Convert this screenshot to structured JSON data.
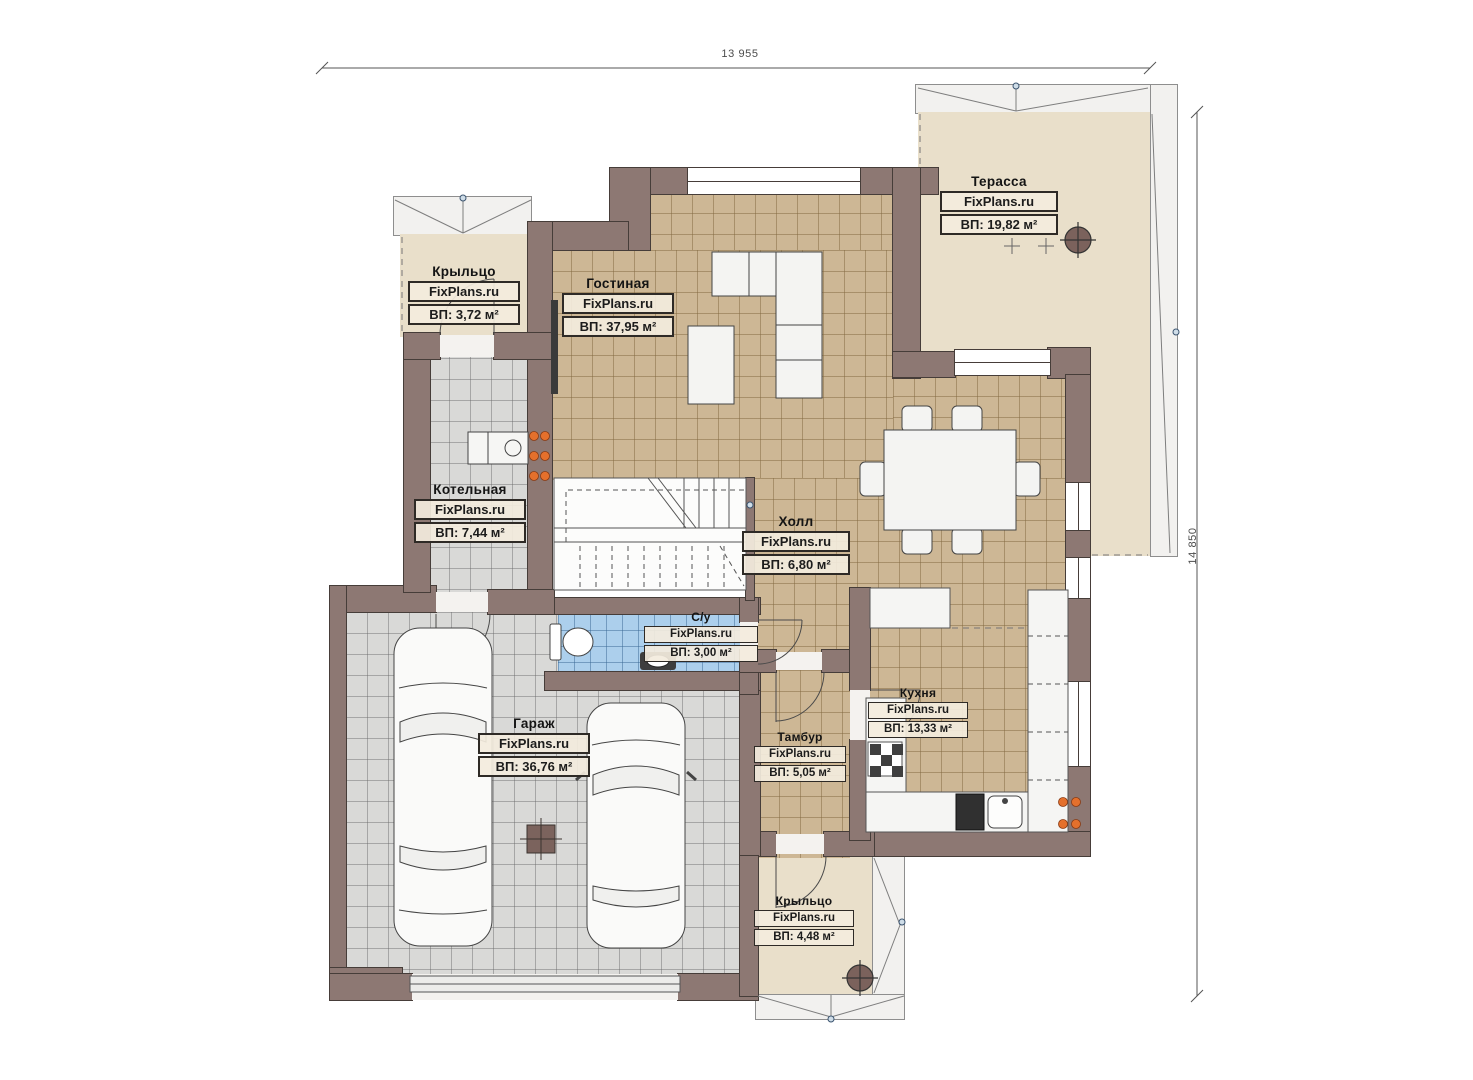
{
  "watermark": "FixPlans.ru",
  "dimensions": {
    "width_label": "13 955",
    "height_label": "14 850"
  },
  "rooms": [
    {
      "id": "terrace",
      "name": "Терасса",
      "watermark": "FixPlans.ru",
      "area": "ВП: 19,82 м²"
    },
    {
      "id": "porch-top",
      "name": "Крыльцо",
      "watermark": "FixPlans.ru",
      "area": "ВП: 3,72 м²"
    },
    {
      "id": "living-room",
      "name": "Гостиная",
      "watermark": "FixPlans.ru",
      "area": "ВП: 37,95 м²"
    },
    {
      "id": "boiler-room",
      "name": "Котельная",
      "watermark": "FixPlans.ru",
      "area": "ВП: 7,44 м²"
    },
    {
      "id": "hall",
      "name": "Холл",
      "watermark": "FixPlans.ru",
      "area": "ВП: 6,80 м²"
    },
    {
      "id": "bathroom",
      "name": "С/у",
      "watermark": "FixPlans.ru",
      "area": "ВП: 3,00 м²"
    },
    {
      "id": "garage",
      "name": "Гараж",
      "watermark": "FixPlans.ru",
      "area": "ВП: 36,76 м²"
    },
    {
      "id": "vestibule",
      "name": "Тамбур",
      "watermark": "FixPlans.ru",
      "area": "ВП: 5,05 м²"
    },
    {
      "id": "kitchen",
      "name": "Кухня",
      "watermark": "FixPlans.ru",
      "area": "ВП: 13,33 м²"
    },
    {
      "id": "porch-bottom",
      "name": "Крыльцо",
      "watermark": "FixPlans.ru",
      "area": "ВП: 4,48 м²"
    }
  ],
  "colors": {
    "wall": "#8d7873",
    "floor_tile_tan": "#cdb795",
    "floor_tile_gray": "#d9d9d7",
    "floor_tile_blue": "#accfec",
    "porch_floor": "#e9dfca",
    "roof_overhang": "#f2f1ef",
    "radiator": "#e4702c",
    "dimension_text": "#4c4c4c"
  }
}
